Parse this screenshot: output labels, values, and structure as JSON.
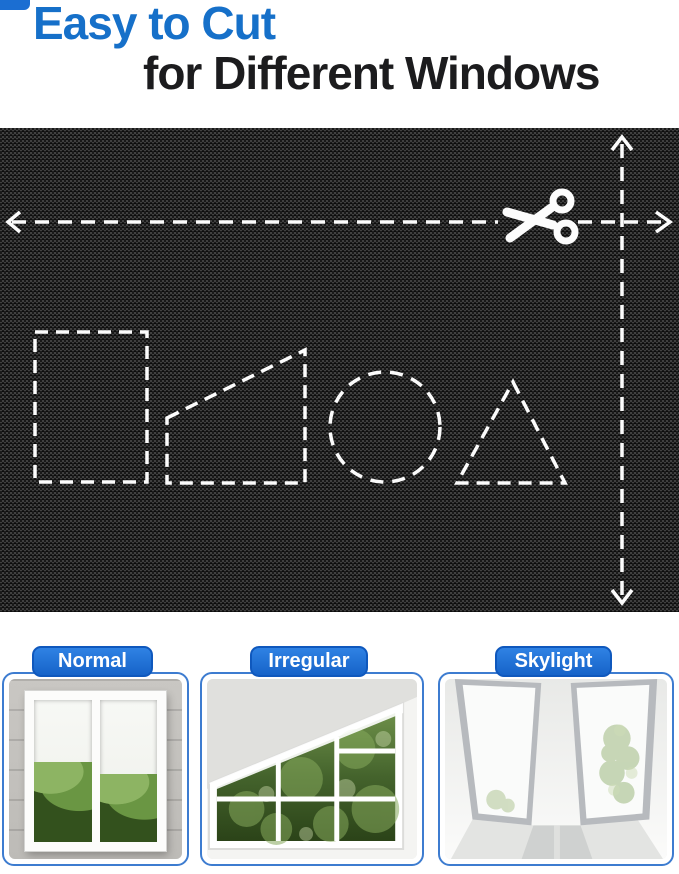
{
  "header": {
    "line1": "Easy to Cut",
    "line2": "for Different Windows"
  },
  "colors": {
    "title_blue": "#1670c9",
    "title_dark": "#1c1c1e",
    "pill_blue": "#1b6ed2",
    "card_border": "#3d7cd0",
    "fabric_dark": "#232323",
    "guide_white": "#fcfcfc"
  },
  "fabric_panel": {
    "icons": [
      "scissors-icon",
      "arrow-left-icon",
      "arrow-right-icon",
      "arrow-up-icon",
      "arrow-down-icon"
    ],
    "cut_shapes": [
      "rectangle",
      "right-trapezoid",
      "circle",
      "triangle"
    ]
  },
  "cards": [
    {
      "label": "Normal"
    },
    {
      "label": "Irregular"
    },
    {
      "label": "Skylight"
    }
  ]
}
